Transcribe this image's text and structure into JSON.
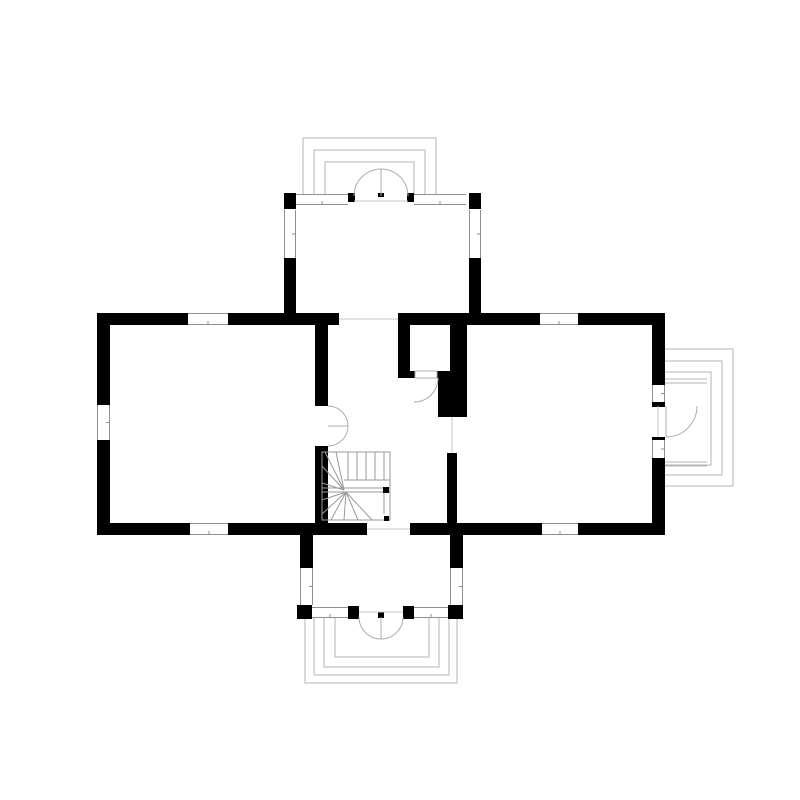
{
  "canvas": {
    "width": 800,
    "height": 800,
    "background": "#ffffff"
  },
  "colors": {
    "wall": "#000000",
    "porch_line": "#b4b4b4",
    "door_line": "#adadad",
    "window_frame": "#8f8f8f",
    "threshold": "#c6c6c6",
    "stair_line": "#9a9a9a",
    "white": "#ffffff"
  },
  "plan": {
    "walls": [
      [
        97,
        313,
        91,
        12
      ],
      [
        228,
        313,
        111,
        12
      ],
      [
        398,
        313,
        142,
        12
      ],
      [
        578,
        313,
        87,
        12
      ],
      [
        97,
        523,
        93,
        12
      ],
      [
        228,
        523,
        139,
        12
      ],
      [
        410,
        523,
        132,
        12
      ],
      [
        578,
        523,
        87,
        12
      ],
      [
        97,
        313,
        13,
        92
      ],
      [
        97,
        440,
        13,
        95
      ],
      [
        652,
        313,
        13,
        72
      ],
      [
        652,
        402,
        13,
        5
      ],
      [
        652,
        437,
        13,
        4
      ],
      [
        652,
        458,
        13,
        77
      ],
      [
        315,
        325,
        13,
        81
      ],
      [
        315,
        446,
        13,
        77
      ],
      [
        398,
        325,
        12,
        53
      ],
      [
        398,
        371,
        17,
        7
      ],
      [
        438,
        371,
        14,
        7
      ],
      [
        450,
        325,
        17,
        53
      ],
      [
        438,
        378,
        29,
        39
      ],
      [
        447,
        453,
        10,
        70
      ],
      [
        284,
        193,
        12,
        16
      ],
      [
        284,
        258,
        12,
        56
      ],
      [
        469,
        193,
        12,
        16
      ],
      [
        469,
        258,
        12,
        56
      ],
      [
        348,
        193,
        7,
        9
      ],
      [
        407,
        193,
        7,
        9
      ],
      [
        378,
        193,
        6,
        4
      ],
      [
        300,
        535,
        13,
        33
      ],
      [
        297,
        605,
        15,
        14
      ],
      [
        450,
        535,
        13,
        33
      ],
      [
        448,
        605,
        15,
        14
      ],
      [
        348,
        606,
        11,
        13
      ],
      [
        403,
        606,
        11,
        13
      ],
      [
        378,
        612,
        6,
        6
      ],
      [
        413,
        371,
        4,
        7
      ],
      [
        436,
        371,
        4,
        7
      ]
    ],
    "windows": [
      [
        188,
        313,
        40,
        12,
        "h"
      ],
      [
        540,
        313,
        38,
        12,
        "h"
      ],
      [
        190,
        523,
        38,
        12,
        "h"
      ],
      [
        542,
        523,
        36,
        12,
        "h"
      ],
      [
        97,
        405,
        13,
        35,
        "v"
      ],
      [
        652,
        385,
        13,
        17,
        "v"
      ],
      [
        652,
        440,
        13,
        18,
        "v"
      ],
      [
        296,
        194,
        52,
        11,
        "h"
      ],
      [
        414,
        194,
        52,
        11,
        "h"
      ],
      [
        284,
        210,
        12,
        48,
        "v"
      ],
      [
        469,
        210,
        12,
        48,
        "v"
      ],
      [
        300,
        568,
        13,
        37,
        "v"
      ],
      [
        450,
        568,
        13,
        37,
        "v"
      ],
      [
        312,
        607,
        36,
        11,
        "h"
      ],
      [
        414,
        607,
        34,
        11,
        "h"
      ]
    ],
    "porch_steps": [
      "M303,196 V138 H436 V196",
      "M314,150 H425 M314,196 V150 M425,150 V196",
      "M325,196 V162 H414 V196",
      "M305,617 V683 H457 V617",
      "M314,617 V675 H449 V617",
      "M324,617 V667 H439 V617",
      "M335,617 V657 H429 V617",
      "M665,349 H733 V486 H665",
      "M665,361 H722 V475 H665",
      "M665,372 H711 V465 H665"
    ],
    "porch_lines": [
      [
        665,
        379,
        707,
        379
      ],
      [
        665,
        383,
        707,
        383
      ],
      [
        665,
        462,
        707,
        462
      ],
      [
        665,
        466,
        707,
        466
      ]
    ],
    "door_arcs": [
      "M354,196 A27,27 0 0 1 381,169",
      "M408,196 A27,27 0 0 0 381,169",
      "M359,617 A22,22 0 0 0 381,639",
      "M403,617 A22,22 0 0 1 381,639",
      "M328,406 A20,20 0 0 1 348,426",
      "M328,446 A20,20 0 0 0 348,426",
      "M438,378 A24,24 0 0 1 414,402",
      "M666,437 A31,31 0 0 0 697,406"
    ],
    "door_lines": [
      [
        381,
        169,
        381,
        196
      ],
      [
        381,
        617,
        381,
        639
      ],
      [
        328,
        426,
        348,
        426
      ],
      [
        666,
        406,
        666,
        437
      ]
    ],
    "door_leafs": [
      [
        415,
        371,
        22,
        7
      ]
    ],
    "thresholds": [
      [
        339,
        319,
        398,
        319
      ],
      [
        367,
        529,
        410,
        529
      ],
      [
        452,
        417,
        452,
        453
      ],
      [
        354,
        201,
        408,
        201
      ],
      [
        359,
        612,
        403,
        612
      ],
      [
        658,
        406,
        658,
        437
      ]
    ],
    "stairs": {
      "frame": [
        322,
        452,
        68,
        68
      ],
      "lines": [
        [
          348,
          452,
          348,
          480
        ],
        [
          357,
          452,
          357,
          480
        ],
        [
          366,
          452,
          366,
          480
        ],
        [
          375,
          452,
          375,
          480
        ],
        [
          384,
          452,
          384,
          480
        ],
        [
          344,
          480,
          390,
          480
        ],
        [
          322,
          488,
          390,
          488
        ],
        [
          322,
          492,
          390,
          492
        ],
        [
          344,
          490,
          322,
          483
        ],
        [
          344,
          490,
          322,
          466
        ],
        [
          344,
          490,
          325,
          452
        ],
        [
          344,
          490,
          336,
          452
        ],
        [
          346,
          492,
          322,
          500
        ],
        [
          346,
          492,
          322,
          514
        ],
        [
          346,
          492,
          331,
          520
        ],
        [
          346,
          492,
          344,
          520
        ],
        [
          346,
          492,
          358,
          520
        ],
        [
          346,
          492,
          372,
          520
        ],
        [
          384,
          492,
          384,
          514
        ]
      ],
      "markers": [
        [
          383,
          487,
          6,
          6
        ],
        [
          384,
          516,
          5,
          5
        ]
      ]
    }
  }
}
